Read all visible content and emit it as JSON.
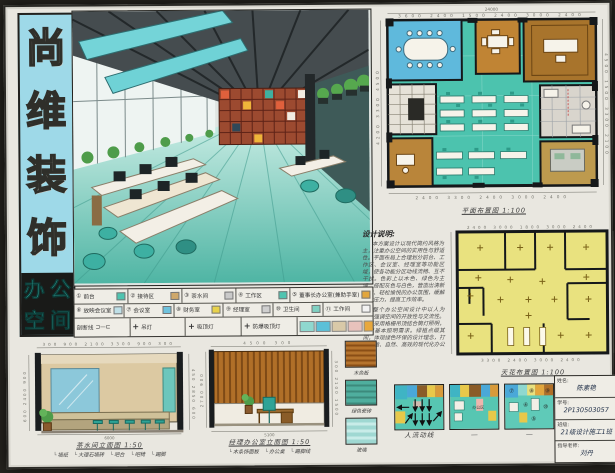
{
  "board": {
    "title_chars": [
      "尚",
      "维",
      "装",
      "饰"
    ],
    "subtitle_chars": [
      "办",
      "公",
      "空",
      "间"
    ]
  },
  "floor_plan": {
    "caption": "平面布置图 1:100",
    "total_width": "24000",
    "dims_top": "3600 2400 1500 2400 3000 2400",
    "dims_bottom": "2400 3300 2400 3000 2400",
    "dims_left": "4200 3300 4500",
    "dims_right": "4500 1500 3300 2100"
  },
  "ceiling_plan": {
    "caption": "天花布置图 1:100",
    "dims_top": "2400 3000 1800 3000 2400",
    "dims_bottom": "3300 2400 3000 2400"
  },
  "design_notes": {
    "title": "设计说明:",
    "para1": "本方案设计以现代简约风格为主，注重办公空间的实用性与舒适性。平面布局上合理划分前台、工作区、会议室、经理室等功能区域，使各功能分区动线流畅、互不干扰。色彩上以木色、绿色为主调，搭配灰色与白色，营造出清新自然、轻松愉悦的办公氛围，缓解工作压力，提高工作效率。",
    "para2": "整个办公空间设计中以人为本，强调空间的开放性与交流性。顶面采用格栅吊顶结合筒灯照明，满足基本照明需求。绿植点缀其间，体现绿色环保的设计理念，打造舒适、自然、高效的现代化办公空间。"
  },
  "legend": {
    "row1": [
      {
        "num": "①",
        "label": "前台",
        "sw": "background:#4fc4b0"
      },
      {
        "num": "②",
        "label": "接待区",
        "sw": "background:#cfa86a"
      },
      {
        "num": "③",
        "label": "茶水间",
        "sw": "background:#c9c9c9"
      },
      {
        "num": "④",
        "label": "工作区",
        "sw": "background:#4fc4b0"
      },
      {
        "num": "⑤",
        "label": "董事长办公室(兼助手室)",
        "sw": "background:#e2a63d"
      }
    ],
    "row2": [
      {
        "num": "⑥",
        "label": "放映会议室",
        "sw": "background:#bfe0e8"
      },
      {
        "num": "⑦",
        "label": "会议室",
        "sw": "background:#6fc2dd"
      },
      {
        "num": "⑧",
        "label": "财务室",
        "sw": "background:#e8d24b"
      },
      {
        "num": "⑨",
        "label": "经理室",
        "sw": "background:#cfcfcf"
      },
      {
        "num": "⑩",
        "label": "卫生间",
        "sw": "background:#7fd0c2"
      },
      {
        "num": "⑪",
        "label": "工作间",
        "sw": "background:#f2f2f2"
      }
    ],
    "row3": {
      "section_line_label": "剖断线",
      "section_line_symbol": "⊐—⊏",
      "lamp_symbol": "+",
      "items": [
        "吊灯",
        "吸顶灯",
        "防爆吸顶灯"
      ],
      "chips": [
        {
          "sw": "background:#8fd8cf"
        },
        {
          "sw": "background:#5bc0d8"
        },
        {
          "sw": "background:#d9c9a8"
        },
        {
          "sw": "background:#e8c2bc"
        },
        {
          "sw": "background:#e8a83d"
        }
      ]
    }
  },
  "elevation1": {
    "caption": "茶水间立面图 1:50",
    "callouts": [
      "墙纸",
      "大理石墙砖",
      "吧台",
      "吧椅",
      "踢脚"
    ],
    "dims_top": "300 900 2100 3300 900 300",
    "dim_bottom": "6000",
    "dims_left": "600 2400 900",
    "dims_right": "450 2850 600"
  },
  "elevation2": {
    "caption": "经理办公室立面图 1:50",
    "callouts": [
      "木条饰面板",
      "办公桌",
      "踢脚线"
    ],
    "dims_top": "4500 300",
    "dim_bottom": "5100",
    "dims_left": "2700 900",
    "dims_right": "300 2100 1500"
  },
  "materials": {
    "items": [
      {
        "label": "木色板"
      },
      {
        "label": "绿色瓷砖"
      },
      {
        "label": "玻璃"
      }
    ]
  },
  "mini_plans": {
    "circulation_caption": "人流动线",
    "middle_label": "办公区",
    "middle_caption": "—",
    "right_caption": "—",
    "zone_numbers": [
      "④",
      "⑤",
      "⑦",
      "⑧",
      "⑨",
      "⑩"
    ]
  },
  "title_block": {
    "fields": [
      {
        "label": "姓名:",
        "value": "陈素艳"
      },
      {
        "label": "学号:",
        "value": "2P130503057"
      },
      {
        "label": "班级:",
        "value": "21级设计施工1班"
      },
      {
        "label": "指导老师:",
        "value": "刘丹"
      }
    ]
  }
}
